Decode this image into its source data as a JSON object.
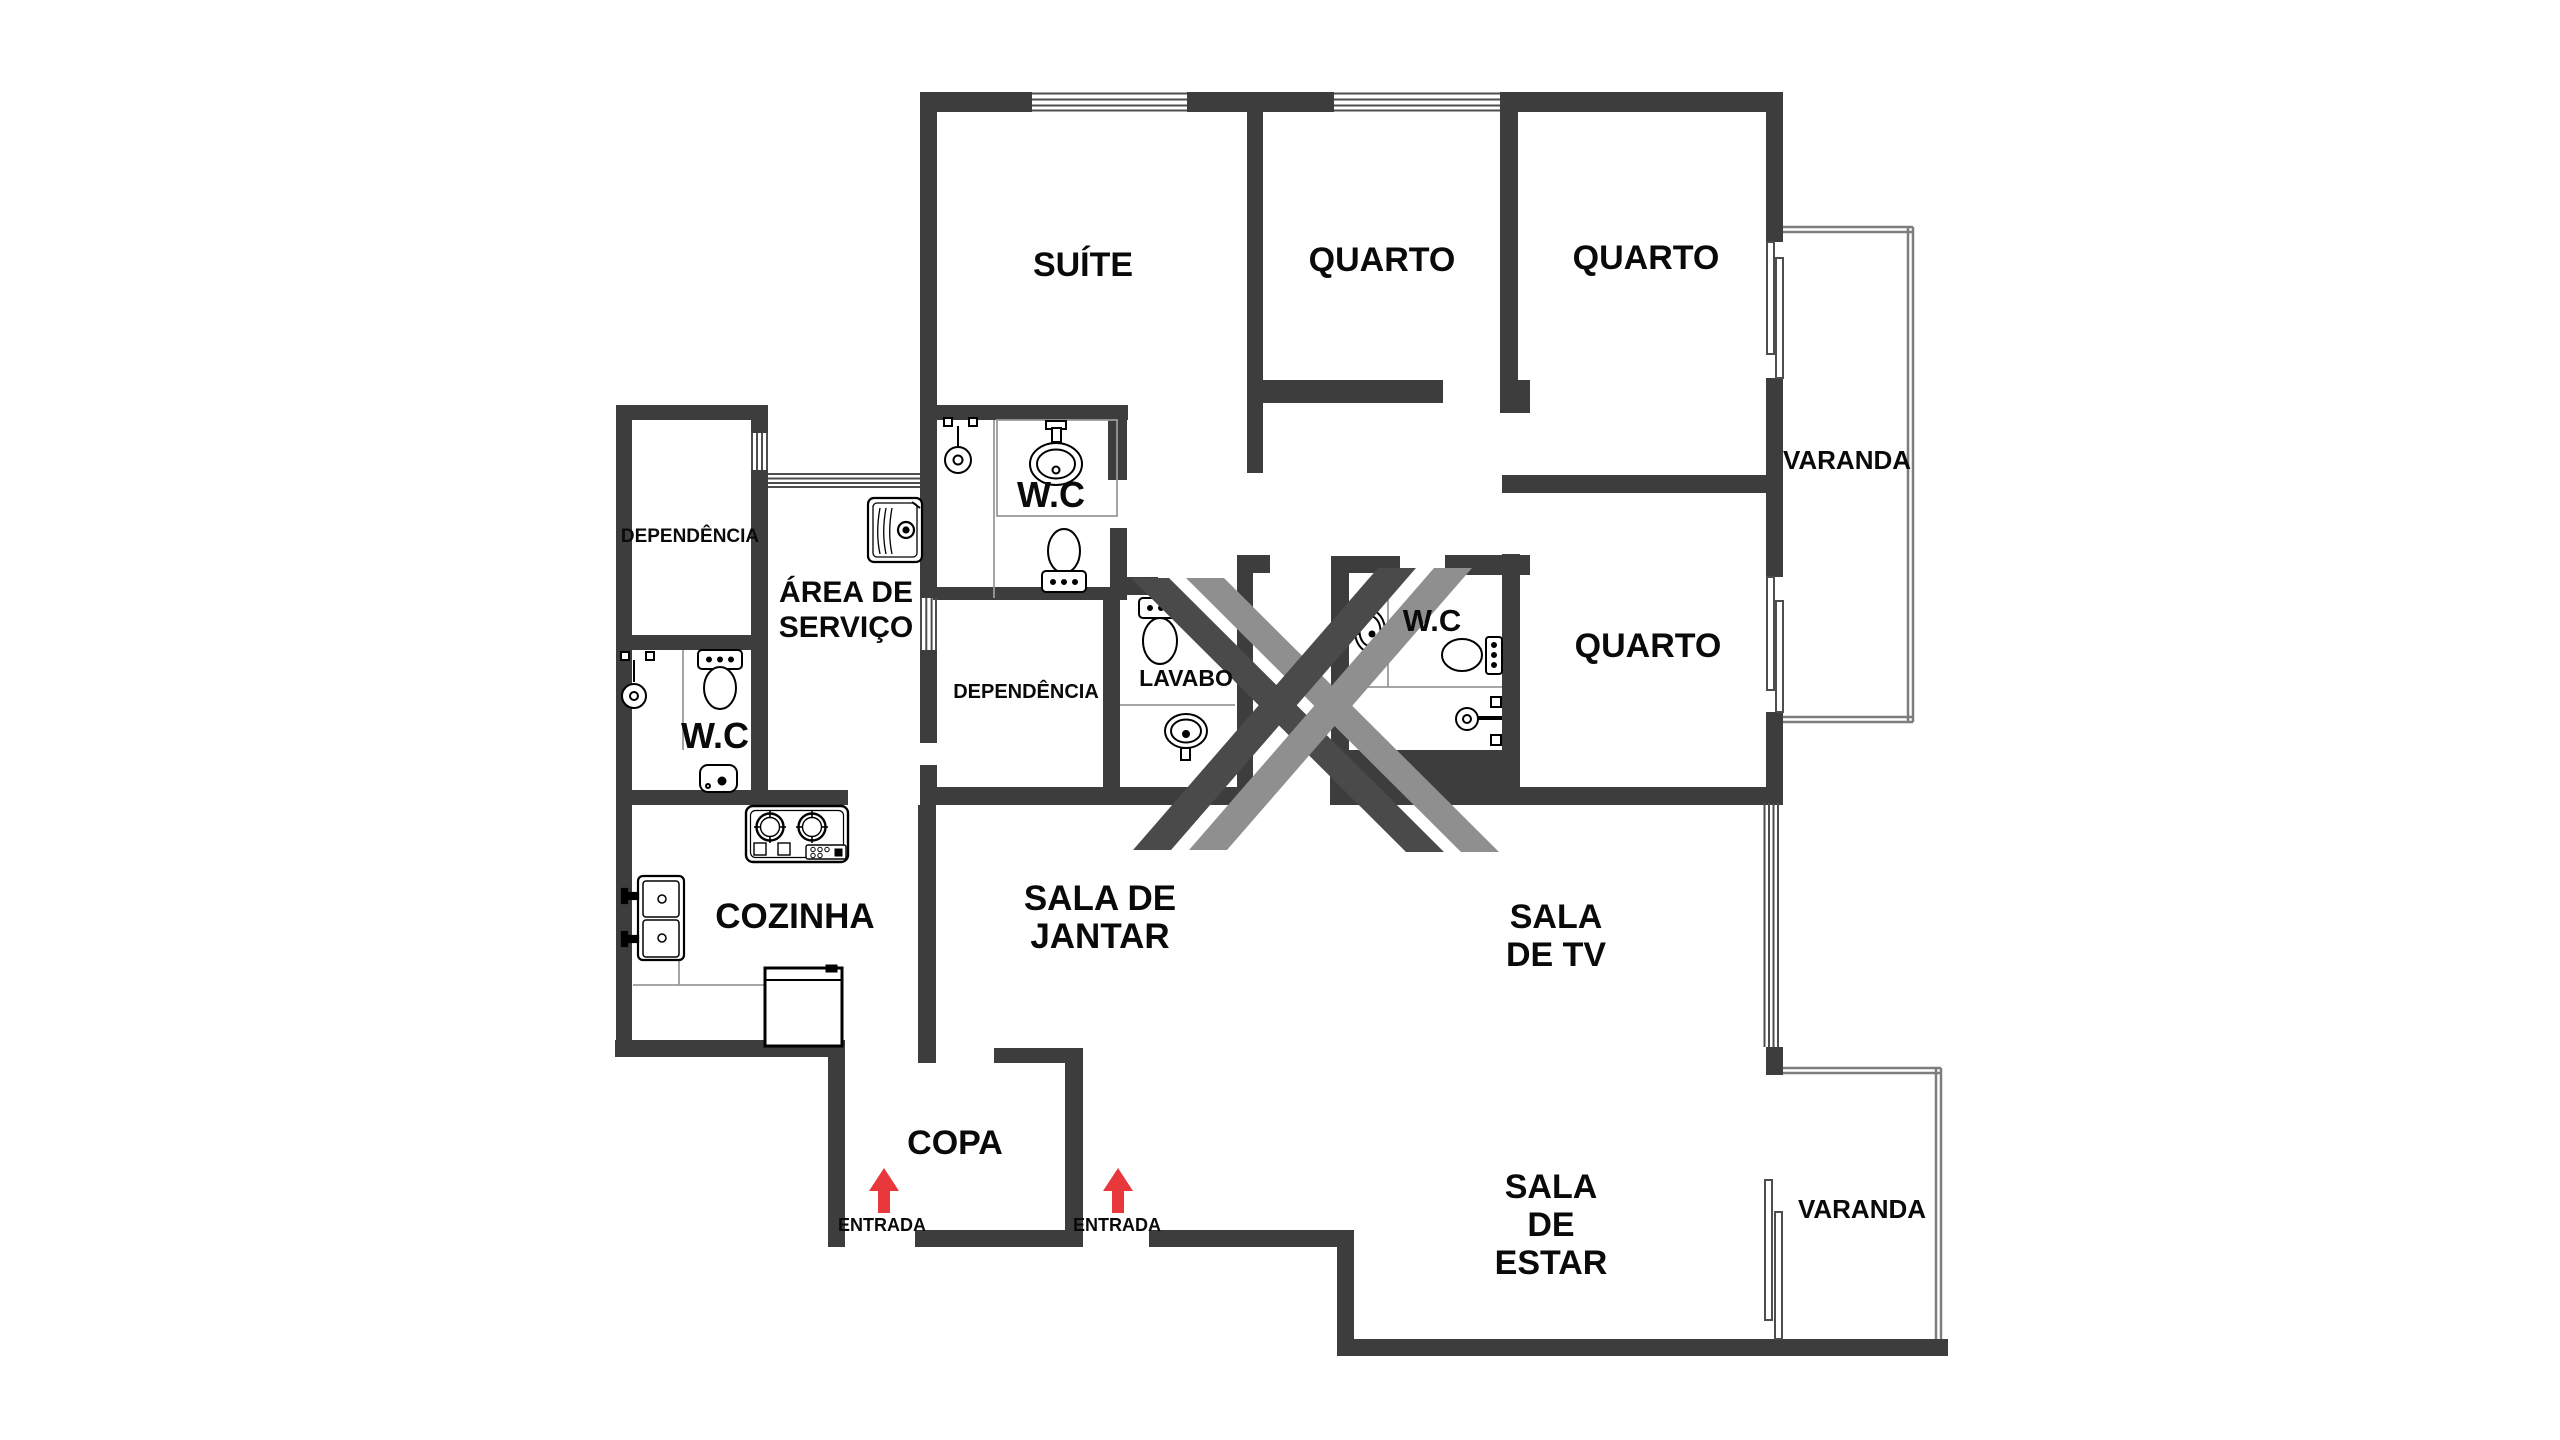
{
  "colors": {
    "wall": "#3d3d3d",
    "accent_red": "#e8383c",
    "watermark_dark": "#4a4a4a",
    "watermark_light": "#8f8f8f",
    "outline_gray": "#7d7d7d"
  },
  "rooms": {
    "suite": "SUÍTE",
    "quarto_top_1": "QUARTO",
    "quarto_top_2": "QUARTO",
    "quarto_right": "QUARTO",
    "varanda_top": "VARANDA",
    "varanda_bottom": "VARANDA",
    "wc_suite": "W.C",
    "wc_service": "W.C",
    "wc_center": "W.C",
    "dependencia_left": "DEPENDÊNCIA",
    "dependencia_center": "DEPENDÊNCIA",
    "lavabo": "LAVABO",
    "area_servico_line1": "ÁREA DE",
    "area_servico_line2": "SERVIÇO",
    "cozinha": "COZINHA",
    "sala_jantar_line1": "SALA DE",
    "sala_jantar_line2": "JANTAR",
    "sala_tv_line1": "SALA",
    "sala_tv_line2": "DE TV",
    "copa": "COPA",
    "sala_estar_line1": "SALA",
    "sala_estar_line2": "DE",
    "sala_estar_line3": "ESTAR",
    "entrada_service": "ENTRADA",
    "entrada_main": "ENTRADA"
  },
  "fixtures": [
    "toilet-icon",
    "sink-icon",
    "shower-icon",
    "laundry-tank-icon",
    "cooktop-icon",
    "kitchen-double-sink-icon",
    "fridge-icon",
    "entrance-arrow-icon",
    "window-glyph",
    "sliding-door-glyph"
  ]
}
